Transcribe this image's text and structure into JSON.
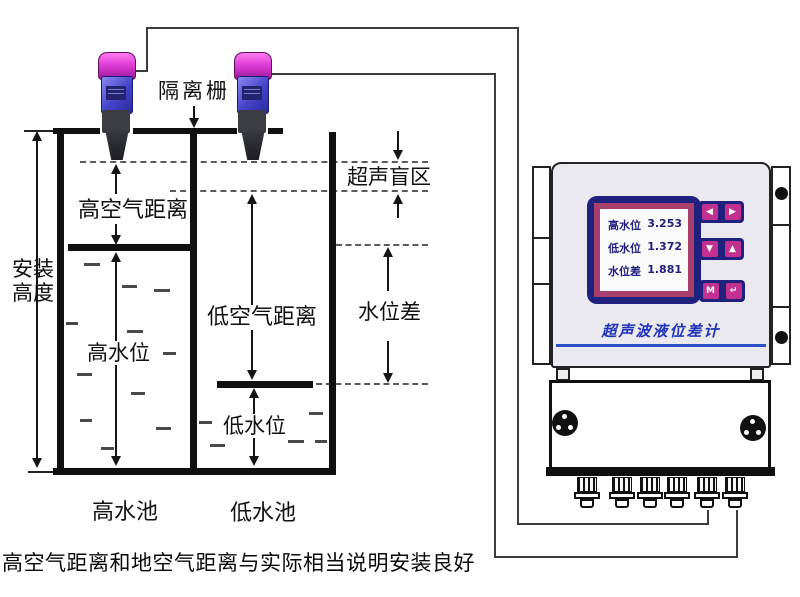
{
  "diagram": {
    "caption": "高空气距离和地空气距离与实际相当说明安装良好",
    "labels": {
      "isolation_grid": "隔离栅",
      "blind_zone": "超声盲区",
      "high_air_distance": "高空气距离",
      "low_air_distance": "低空气距离",
      "level_difference": "水位差",
      "high_water_level": "高水位",
      "low_water_level": "低水位",
      "install_height_line1": "安装",
      "install_height_line2": "高度",
      "high_tank": "高水池",
      "low_tank": "低水池"
    }
  },
  "device": {
    "title": "超声波液位差计",
    "display": {
      "rows": [
        {
          "label": "高水位",
          "value": "3.253"
        },
        {
          "label": "低水位",
          "value": "1.372"
        },
        {
          "label": "水位差",
          "value": "1.881"
        }
      ]
    },
    "keypad": {
      "row1": {
        "left": "◀",
        "right": "▶"
      },
      "row2": {
        "left": "▼",
        "right": "▲"
      },
      "row3": {
        "left": "M",
        "right": "↵"
      }
    }
  },
  "colors": {
    "sensor_cap_magenta": "#e03fd8",
    "sensor_body_blue": "#4343c8",
    "lcd_frame_navy": "#20207e",
    "lcd_ring_purple": "#a8406e",
    "key_pink": "#c23090",
    "device_title_blue": "#2233bb",
    "accent_line_blue": "#2a52c8",
    "panel_gray": "#e9e9ef"
  }
}
